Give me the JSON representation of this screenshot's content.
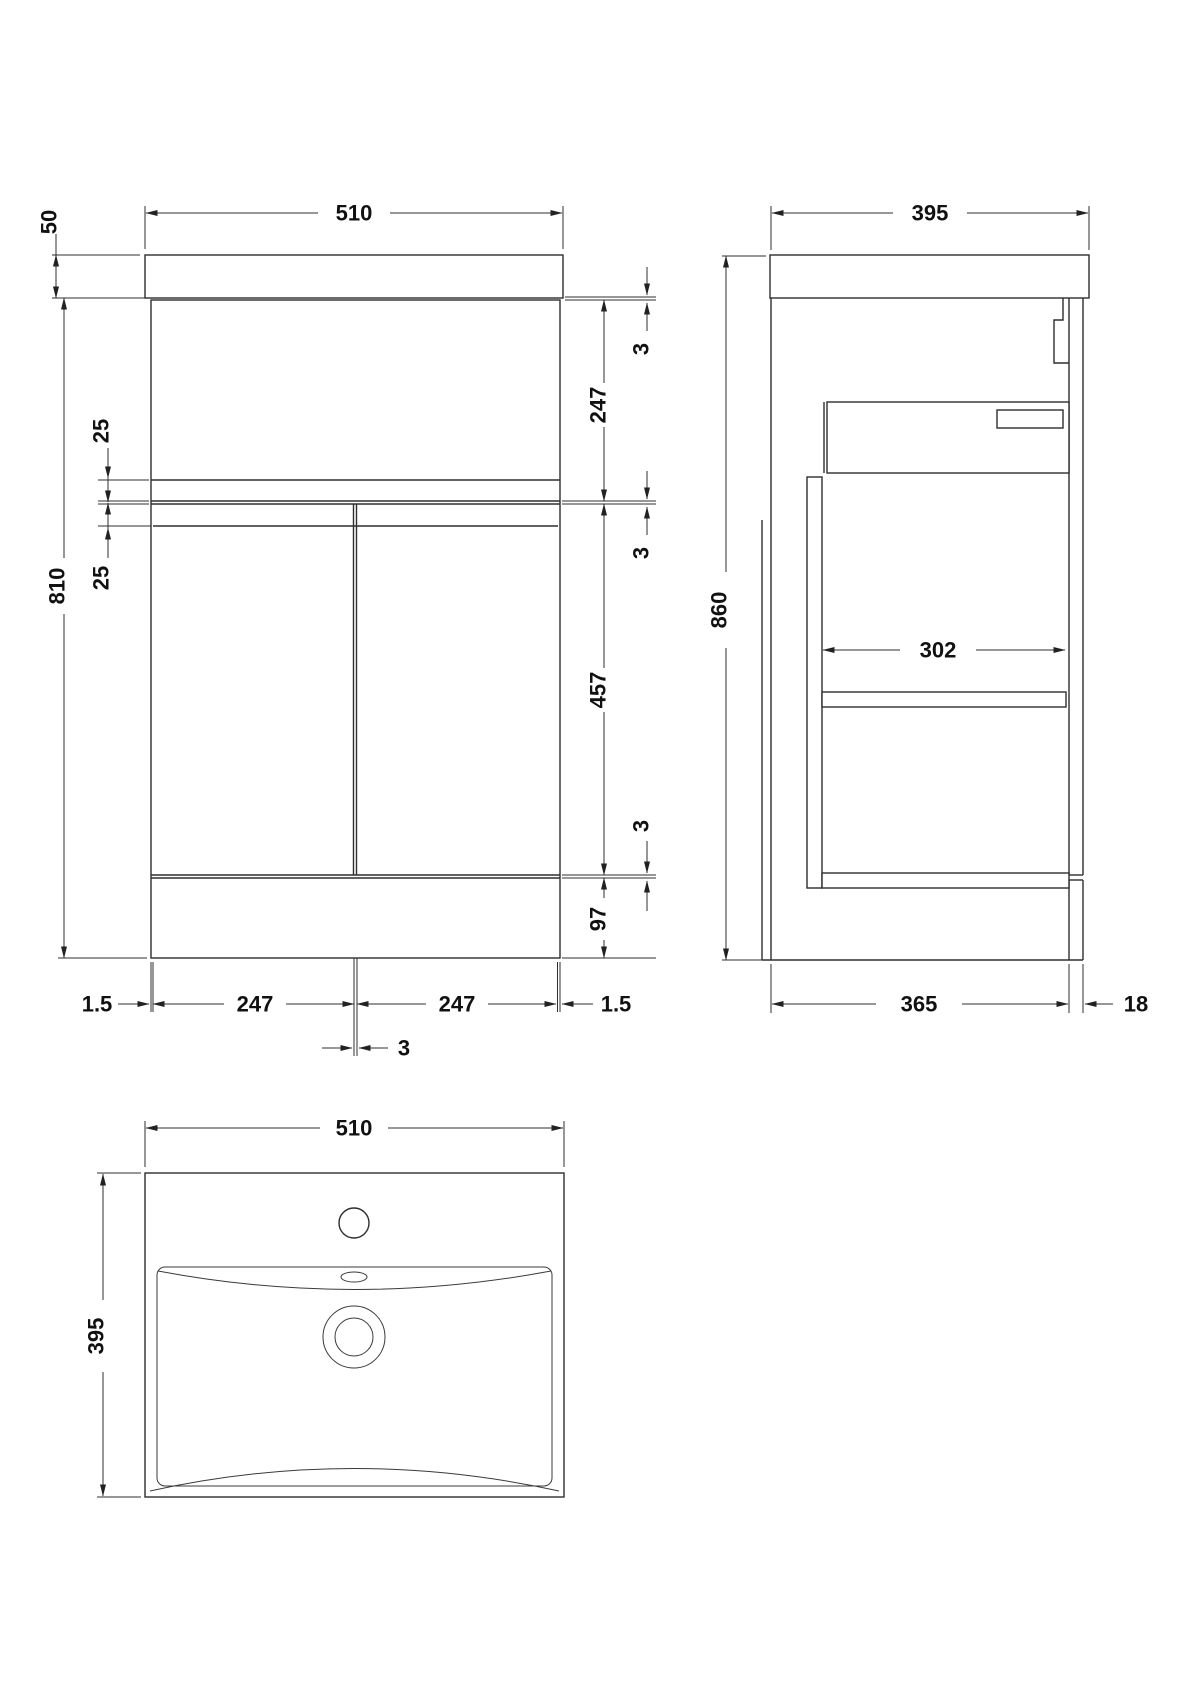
{
  "drawing": {
    "front": {
      "width": "510",
      "counter_height": "50",
      "cabinet_height": "810",
      "rail_top": "25",
      "rail_bottom": "25",
      "gap_top": "3",
      "panel_height": "247",
      "gap_mid": "3",
      "door_height": "457",
      "gap_low": "3",
      "plinth_height": "97",
      "edge_left": "1.5",
      "door_left_width": "247",
      "door_right_width": "247",
      "edge_right": "1.5",
      "door_gap": "3"
    },
    "side": {
      "depth": "395",
      "height": "860",
      "inner_depth": "302",
      "body_depth": "365",
      "panel_thickness": "18"
    },
    "plan": {
      "width": "510",
      "depth": "395"
    }
  }
}
